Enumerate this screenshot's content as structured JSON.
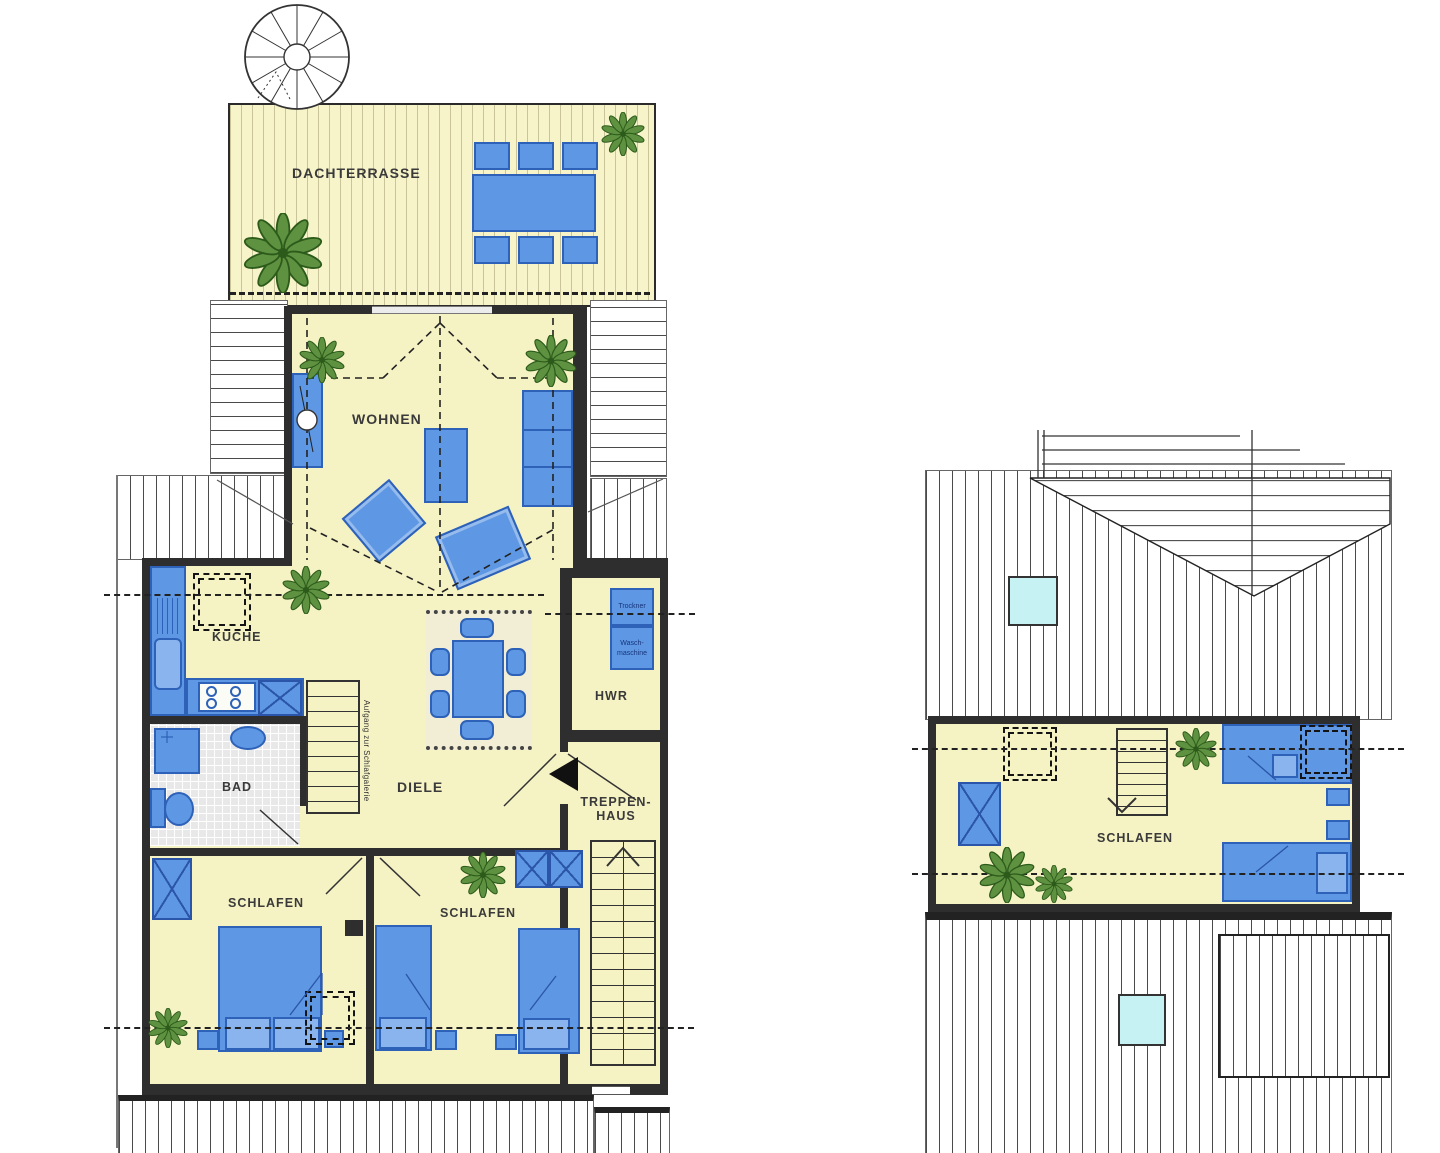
{
  "colors": {
    "floor_yellow": "#f5f2c4",
    "furniture_blue": "#5e97e3",
    "wall_dark": "#2e2e2e",
    "skylight_cyan": "#c6f2f4",
    "plant_green": "#5e9140",
    "bath_tile_gray": "#e8e8e8"
  },
  "upper_floor": {
    "rooms": {
      "dachterrasse": {
        "label": "DACHTERRASSE"
      },
      "wohnen": {
        "label": "WOHNEN"
      },
      "kueche": {
        "label": "KÜCHE"
      },
      "bad": {
        "label": "BAD"
      },
      "diele": {
        "label": "DIELE"
      },
      "hwr": {
        "label": "HWR"
      },
      "treppenhaus": {
        "label_line1": "TREPPEN-",
        "label_line2": "HAUS"
      },
      "schlafen_left": {
        "label": "SCHLAFEN"
      },
      "schlafen_right": {
        "label": "SCHLAFEN"
      }
    },
    "annotations": {
      "gallery_stair_note": "Aufgang zur Schlafgalerie",
      "dryer_label": "Trockner",
      "washer_label_line1": "Wasch-",
      "washer_label_line2": "maschine"
    }
  },
  "gallery_floor": {
    "rooms": {
      "schlafen": {
        "label": "SCHLAFEN"
      }
    }
  }
}
